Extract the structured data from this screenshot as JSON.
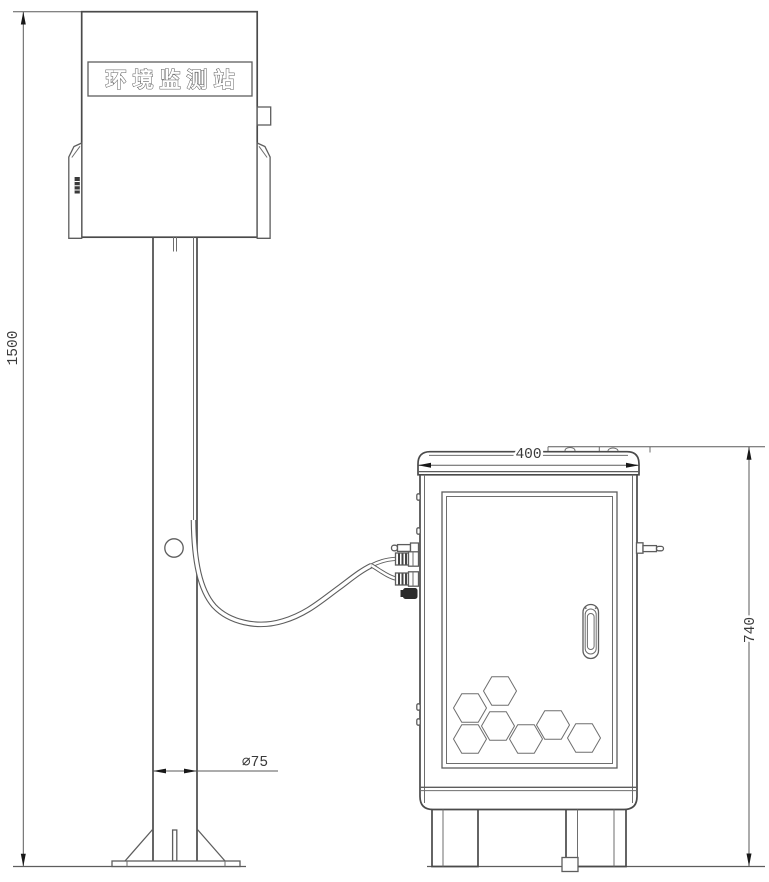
{
  "station": {
    "label": "环境监测站"
  },
  "dims": {
    "pole_height": "1500",
    "pole_diameter": "∅75",
    "cabinet_width": "400",
    "cabinet_height": "740"
  },
  "colors": {
    "line": "#5d5d5d",
    "outline": "#4a4a4a",
    "arrow": "#181818",
    "text": "#3a3a3a",
    "background": "#ffffff"
  }
}
